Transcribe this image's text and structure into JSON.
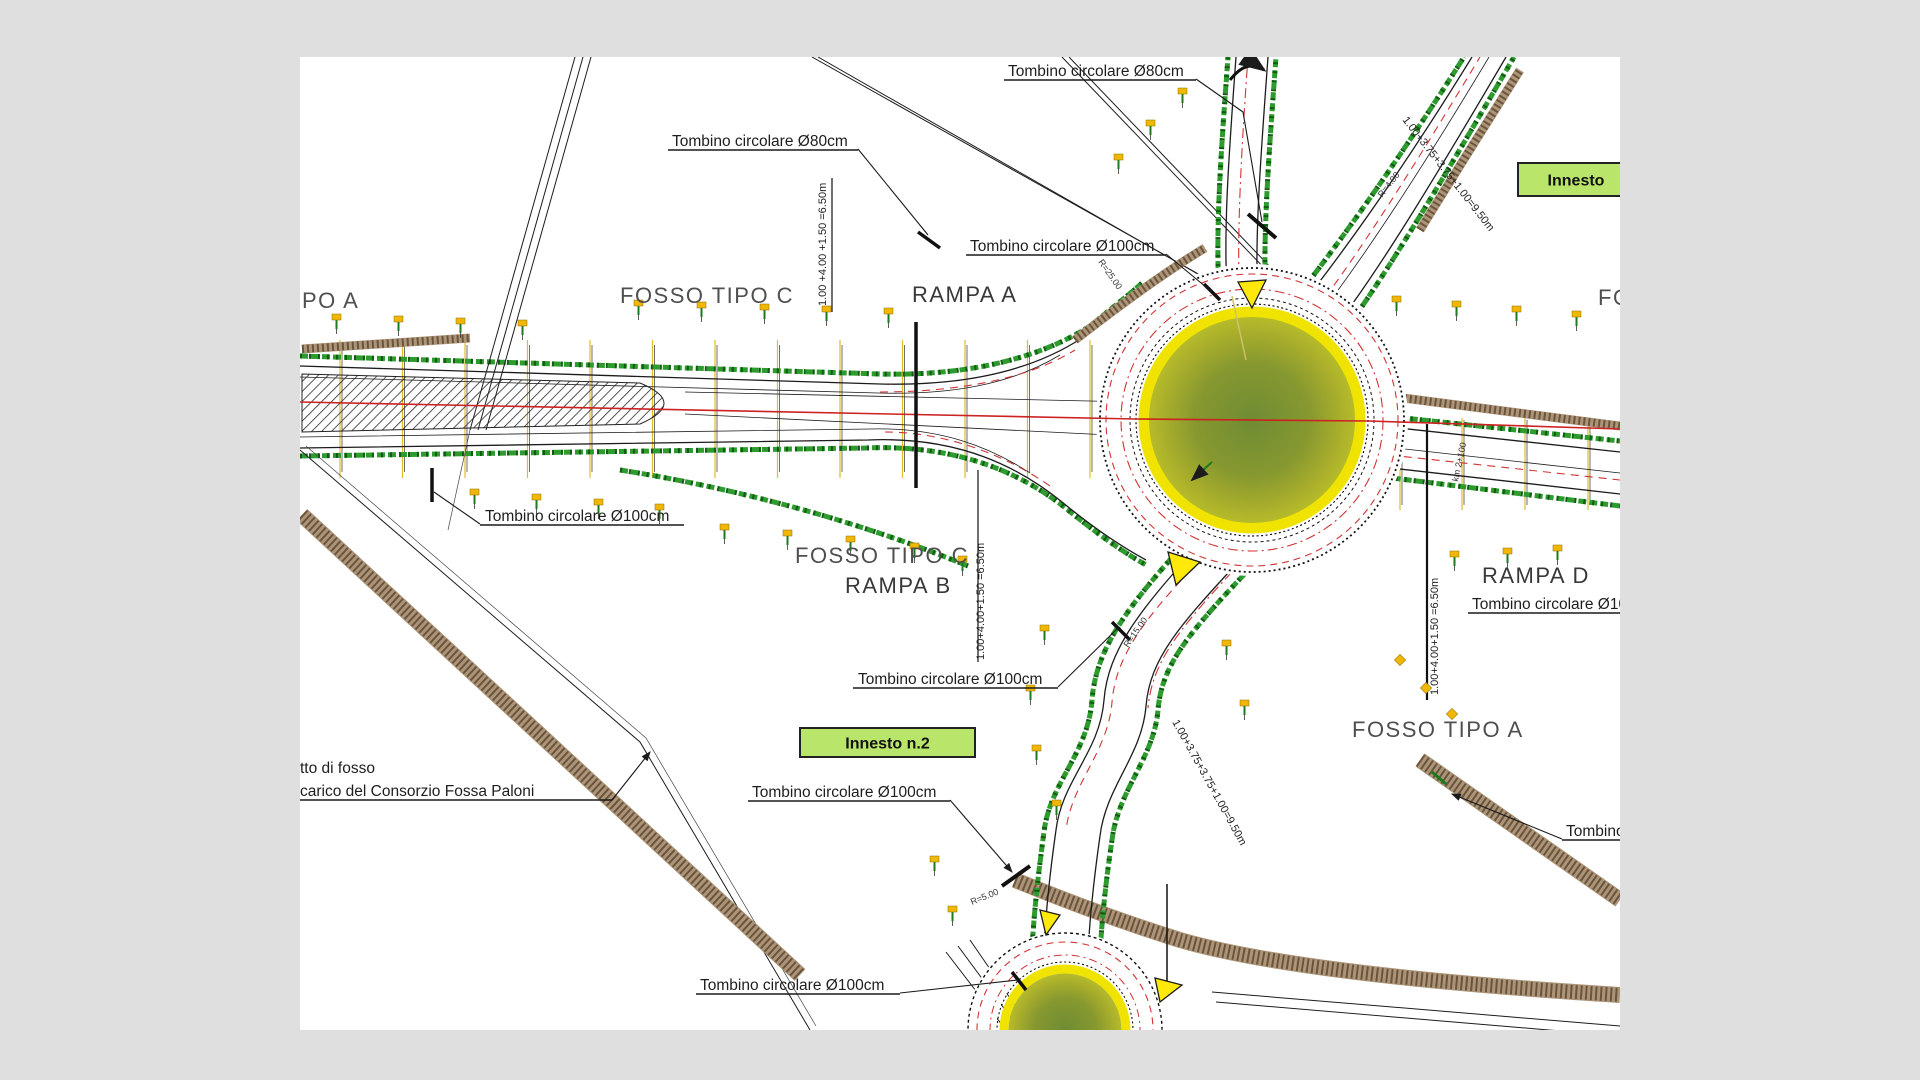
{
  "drawing_title": "Planimetria rotatoria - progetto stradale",
  "palette": {
    "bg": "#dfdfdf",
    "canvas": "#ffffff",
    "ink": "#1c1c1c",
    "gray_text": "#4f4f4f",
    "dark_text": "#333333",
    "green_band": "#2e9b2e",
    "green_dark": "#0f5c10",
    "brown_band": "#ac9478",
    "brown_dark": "#6a543c",
    "red_line": "#cc2222",
    "red_dash": "#d03434",
    "yellow_ring": "#f0e300",
    "island_edge": "#b6bb2a",
    "island_mid": "#86982f",
    "island_center": "#6f8c34",
    "marker_yellow": "#f2b705",
    "triangle_yellow": "#ffe90a",
    "innesto_fill": "#b9e56a",
    "section_yellow": "#e0bc2a"
  },
  "area_labels": [
    {
      "text": "PO A",
      "x": 302,
      "y": 308,
      "size": 22,
      "color": "#4f4f4f"
    },
    {
      "text": "FOSSO TIPO C",
      "x": 620,
      "y": 303,
      "size": 22,
      "color": "#4f4f4f"
    },
    {
      "text": "RAMPA A",
      "x": 912,
      "y": 302,
      "size": 22,
      "color": "#383838"
    },
    {
      "text": "FOSSO TIPO C",
      "x": 795,
      "y": 563,
      "size": 22,
      "color": "#4f4f4f"
    },
    {
      "text": "RAMPA B",
      "x": 845,
      "y": 593,
      "size": 22,
      "color": "#383838"
    },
    {
      "text": "RAMPA D",
      "x": 1482,
      "y": 583,
      "size": 22,
      "color": "#383838"
    },
    {
      "text": "FOSSO TIPO A",
      "x": 1352,
      "y": 737,
      "size": 22,
      "color": "#4f4f4f"
    },
    {
      "text": "FO",
      "x": 1598,
      "y": 305,
      "size": 22,
      "color": "#4f4f4f"
    }
  ],
  "callouts": [
    {
      "text": "Tombino circolare Ø80cm",
      "x": 1008,
      "y": 76,
      "ux1": 1004,
      "ux2": 1196,
      "leader": [
        [
          1196,
          79
        ],
        [
          1243,
          112
        ],
        [
          1262,
          222
        ]
      ],
      "arrow": false
    },
    {
      "text": "Tombino circolare Ø80cm",
      "x": 672,
      "y": 146,
      "ux1": 668,
      "ux2": 858,
      "leader": [
        [
          858,
          149
        ],
        [
          928,
          235
        ]
      ],
      "arrow": false
    },
    {
      "text": "Tombino circolare Ø100cm",
      "x": 970,
      "y": 251,
      "ux1": 966,
      "ux2": 1166,
      "leader": [
        [
          1166,
          254
        ],
        [
          1212,
          292
        ]
      ],
      "arrow": false
    },
    {
      "text": "Tombino circolare Ø100cm",
      "x": 485,
      "y": 521,
      "ux1": 480,
      "ux2": 684,
      "leader": [
        [
          480,
          524
        ],
        [
          434,
          492
        ]
      ],
      "arrow": false
    },
    {
      "text": "Tombino circolare Ø100cm",
      "x": 858,
      "y": 684,
      "ux1": 853,
      "ux2": 1058,
      "leader": [
        [
          1058,
          687
        ],
        [
          1118,
          628
        ]
      ],
      "arrow": false
    },
    {
      "text": "Tombino circolare Ø100cm",
      "x": 1472,
      "y": 609,
      "ux1": 1468,
      "ux2": 1622,
      "leader": [],
      "arrow": false
    },
    {
      "text": "Tombino circolare Ø100cm",
      "x": 752,
      "y": 797,
      "ux1": 748,
      "ux2": 950,
      "leader": [
        [
          950,
          800
        ],
        [
          1012,
          872
        ]
      ],
      "arrow": true
    },
    {
      "text": "Tombino circolare Ø100cm",
      "x": 700,
      "y": 990,
      "ux1": 696,
      "ux2": 900,
      "leader": [
        [
          900,
          993
        ],
        [
          1018,
          980
        ]
      ],
      "arrow": false
    },
    {
      "text": "Tombino circolare Ø100cm",
      "x": 1566,
      "y": 836,
      "ux1": 1562,
      "ux2": 1622,
      "leader": [
        [
          1562,
          839
        ],
        [
          1452,
          794
        ]
      ],
      "arrow": true
    }
  ],
  "note": {
    "line1": "tto di fosso",
    "line2": "carico del Consorzio Fossa Paloni",
    "x": 300,
    "y1": 773,
    "y2": 796,
    "ux1": 300,
    "ux2": 612,
    "uy": 800,
    "leader": [
      [
        612,
        800
      ],
      [
        650,
        752
      ]
    ],
    "arrow": true
  },
  "dim_labels": [
    {
      "text": "1.00 +4.00 +1.50 =6.50m",
      "x": 826,
      "y": 306,
      "rot": -90,
      "size": 11
    },
    {
      "text": "1.00+4.00+1.50 =6.50m",
      "x": 984,
      "y": 660,
      "rot": -90,
      "size": 11
    },
    {
      "text": "1.00+4.00+1.50 =6.50m",
      "x": 1438,
      "y": 695,
      "rot": -90,
      "size": 11
    },
    {
      "text": "1.00+3.75+3.75+1.00=9.50m",
      "x": 1402,
      "y": 120,
      "rot": 52,
      "size": 11
    },
    {
      "text": "1.00+3.75+3.75+1.00=9.50m",
      "x": 1172,
      "y": 722,
      "rot": 61,
      "size": 11
    }
  ],
  "small_labels": [
    {
      "text": "R=4.00",
      "x": 1382,
      "y": 198,
      "rot": -52,
      "size": 9
    },
    {
      "text": "R=5.00",
      "x": 972,
      "y": 905,
      "rot": -22,
      "size": 9
    },
    {
      "text": "km 2+100",
      "x": 1458,
      "y": 482,
      "rot": -78,
      "size": 9
    },
    {
      "text": "R=25.00",
      "x": 1098,
      "y": 262,
      "rot": 55,
      "size": 9
    },
    {
      "text": "R=15.00",
      "x": 1128,
      "y": 648,
      "rot": -55,
      "size": 9
    }
  ],
  "boxes": [
    {
      "text": "Innesto n.2",
      "x": 800,
      "y": 728,
      "w": 175,
      "h": 29
    },
    {
      "text": "Innesto",
      "x": 1518,
      "y": 163,
      "w": 116,
      "h": 33
    }
  ]
}
